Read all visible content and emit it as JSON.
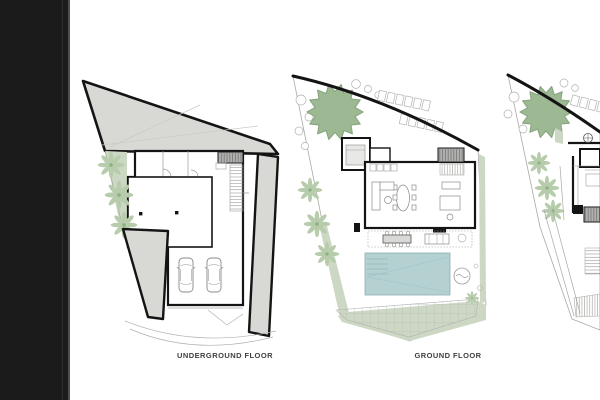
{
  "window": {
    "width": 600,
    "height": 400,
    "background": "#ffffff"
  },
  "sidebar": {
    "color": "#1b1b1b"
  },
  "figure": {
    "type": "architectural floor plans, villa on irregular sloped lot",
    "plans": [
      {
        "name": "underground-floor",
        "caption": "UNDERGROUND FLOOR",
        "features": [
          "earth mass fill",
          "garage with two cars",
          "entry ramp",
          "stairs",
          "palm trees",
          "driveway curves"
        ]
      },
      {
        "name": "ground-floor",
        "caption": "GROUND FLOOR",
        "features": [
          "large round tree",
          "palm trees",
          "living-dining block",
          "outdoor terrace",
          "swimming pool",
          "gridded deck",
          "lawn borders",
          "spa circle"
        ]
      },
      {
        "name": "right-plan-cropped",
        "cropped_at_right_edge": true,
        "features": [
          "large round tree",
          "palm trees",
          "partial building walls",
          "stairs",
          "hatched paving"
        ]
      }
    ]
  },
  "palette": {
    "outline_black": "#141414",
    "earth_gray": "#d8d9d5",
    "stair_gray": "#b1b1af",
    "tree_green": "#9cb993",
    "palm_green": "#b6ccab",
    "lawn_green": "#ccd8c3",
    "pool_blue": "#b4d0d1",
    "thin_line_gray": "#a3a4a0",
    "caption_text": "#3f3f3f"
  }
}
